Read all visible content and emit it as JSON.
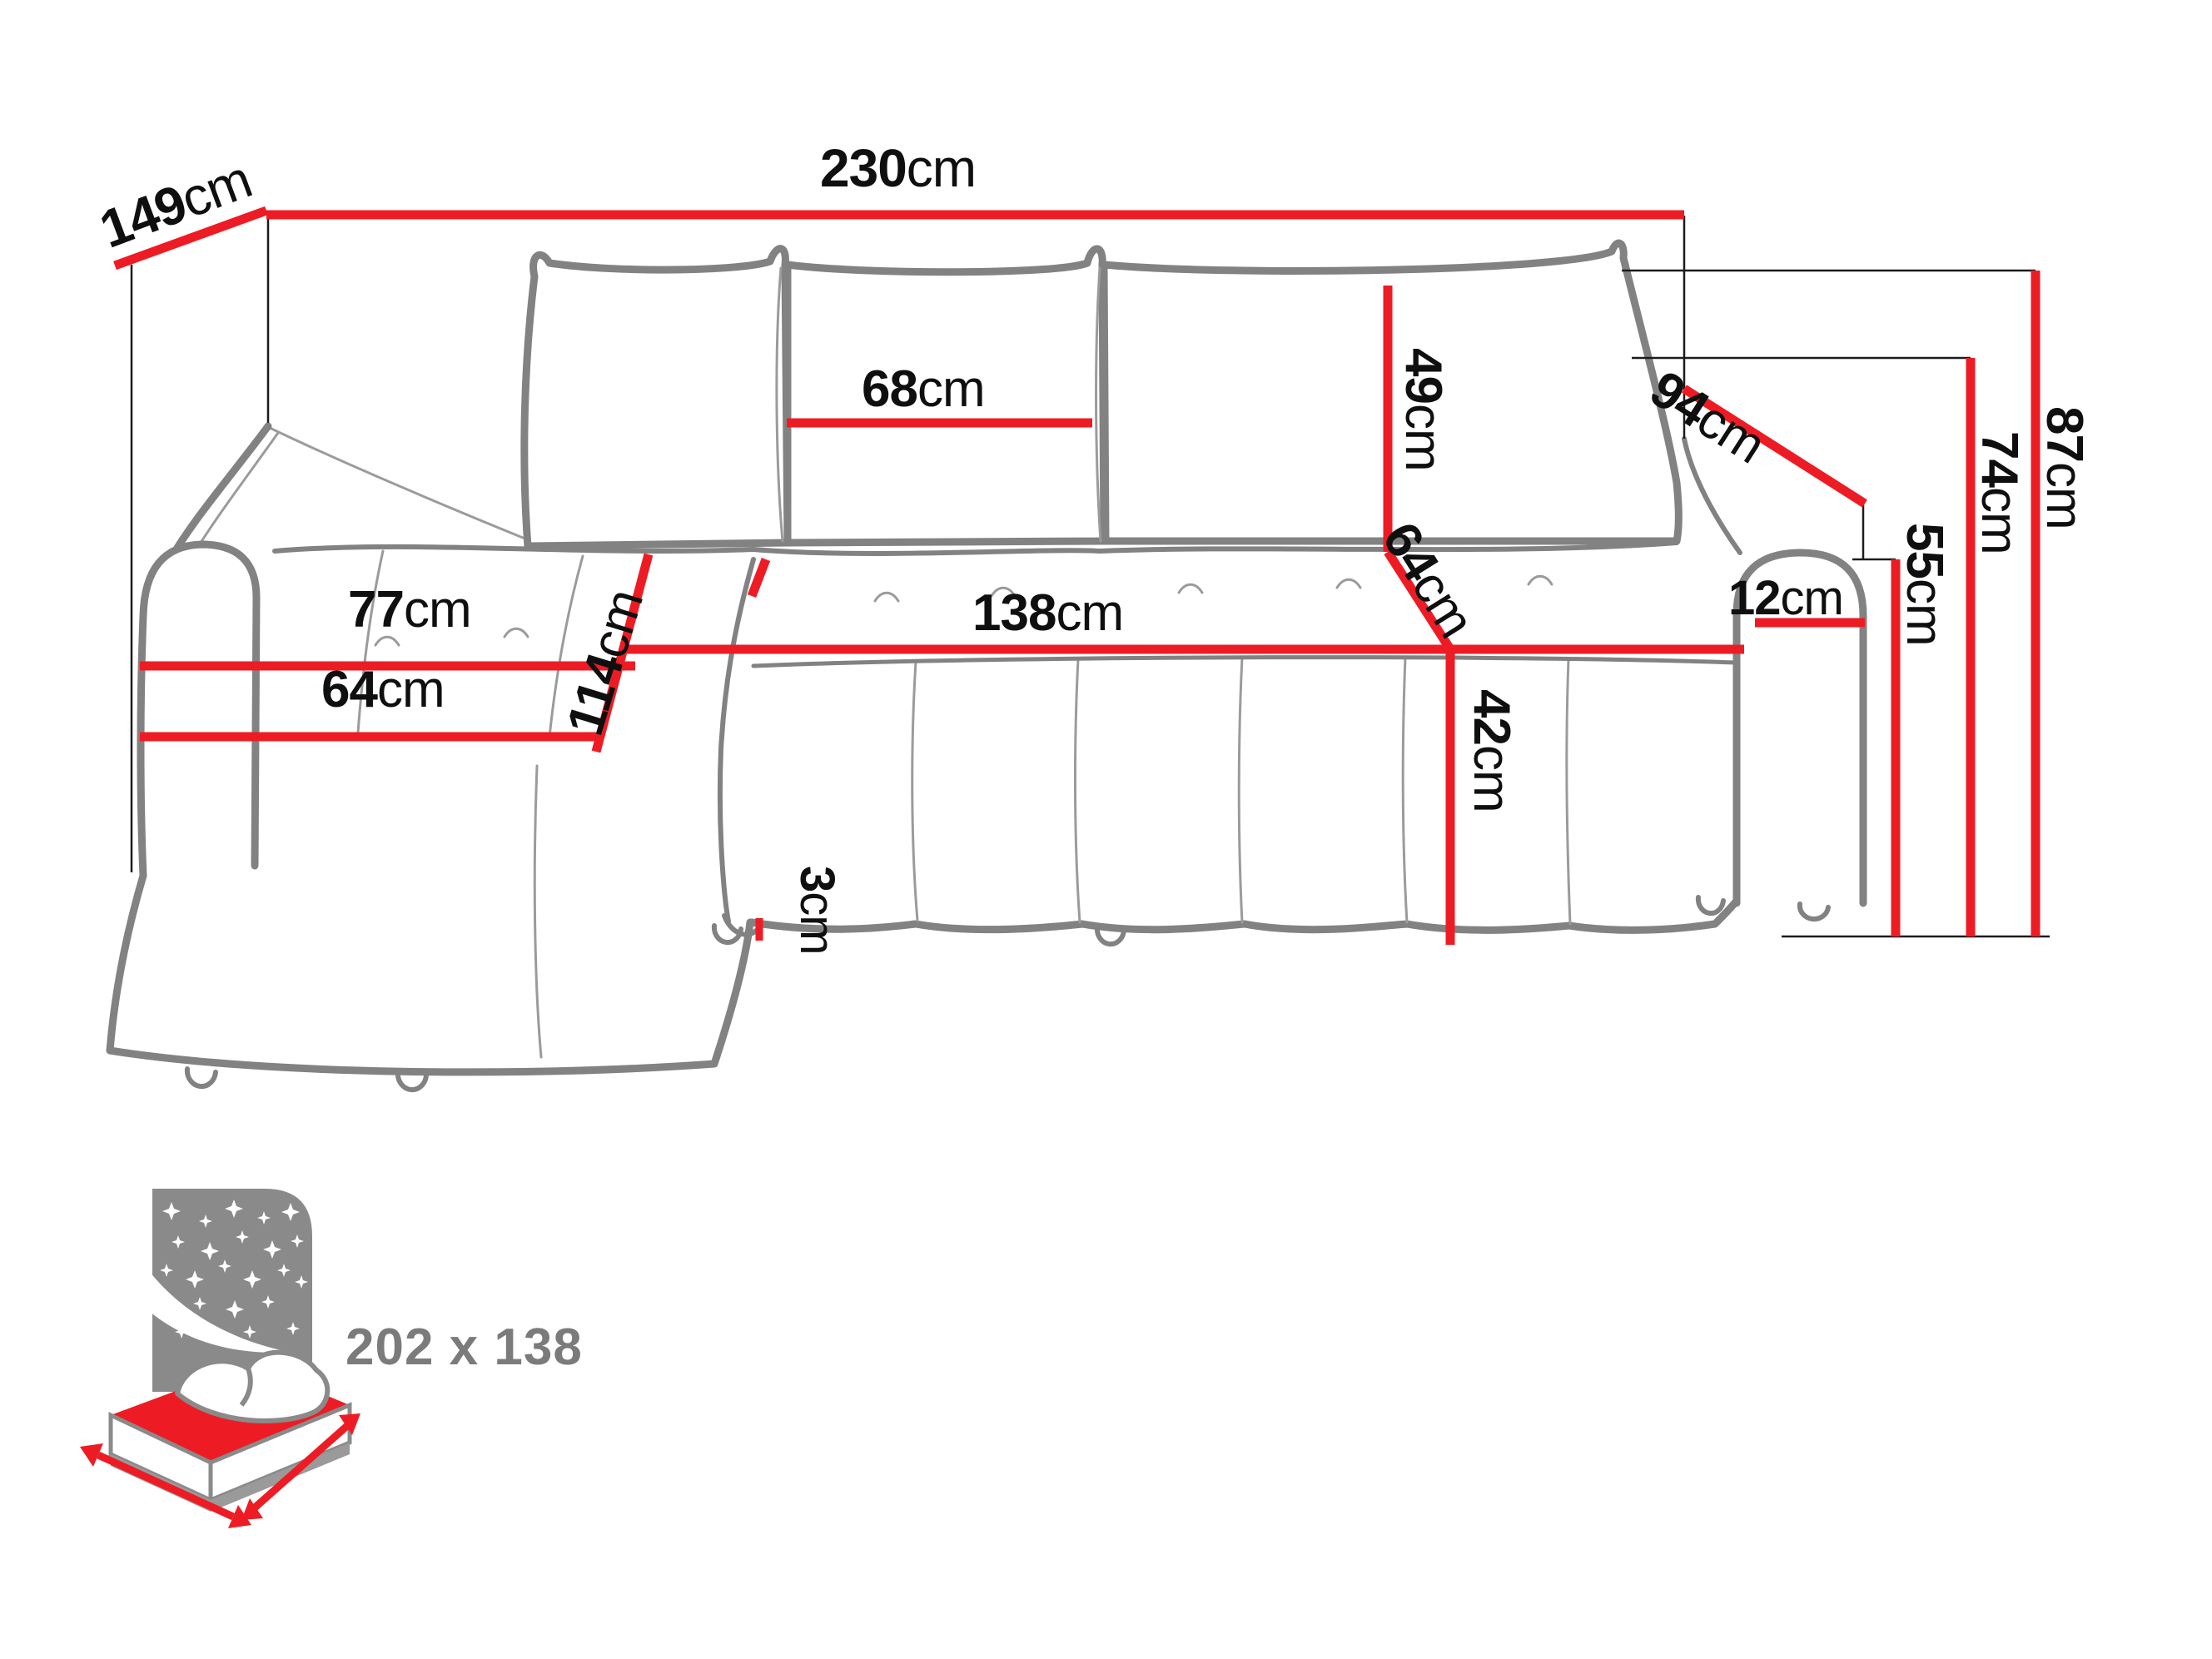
{
  "diagram": {
    "type": "corner sofa-bed dimension drawing",
    "unit": "cm",
    "dims": {
      "total_width": {
        "value": "230",
        "unit": "cm"
      },
      "total_depth": {
        "value": "149",
        "unit": "cm"
      },
      "back_cushion_width": {
        "value": "68",
        "unit": "cm"
      },
      "back_cushion_height": {
        "value": "49",
        "unit": "cm"
      },
      "corner_diagonal": {
        "value": "94",
        "unit": "cm"
      },
      "seat_depth": {
        "value": "64",
        "unit": "cm"
      },
      "chaise_seat_length": {
        "value": "77",
        "unit": "cm"
      },
      "chaise_diagonal": {
        "value": "114",
        "unit": "cm"
      },
      "seat_front_width": {
        "value": "138",
        "unit": "cm"
      },
      "chaise_front_width": {
        "value": "64",
        "unit": "cm"
      },
      "armrest_width": {
        "value": "12",
        "unit": "cm"
      },
      "seat_height": {
        "value": "42",
        "unit": "cm"
      },
      "floor_gap": {
        "value": "3",
        "unit": "cm"
      },
      "armrest_height": {
        "value": "55",
        "unit": "cm"
      },
      "backrest_height": {
        "value": "74",
        "unit": "cm"
      },
      "total_height": {
        "value": "87",
        "unit": "cm"
      }
    },
    "sleeping_area": {
      "label": "202 x 138"
    },
    "colors": {
      "dimension_red": "#ed1c24",
      "sofa_outline_gray": "#828282",
      "guide_black": "#1c1c1c",
      "label_black": "#0f0f0f",
      "pictogram_gray": "#8a8a8a",
      "sleeping_text_gray": "#7b7b7b"
    }
  }
}
